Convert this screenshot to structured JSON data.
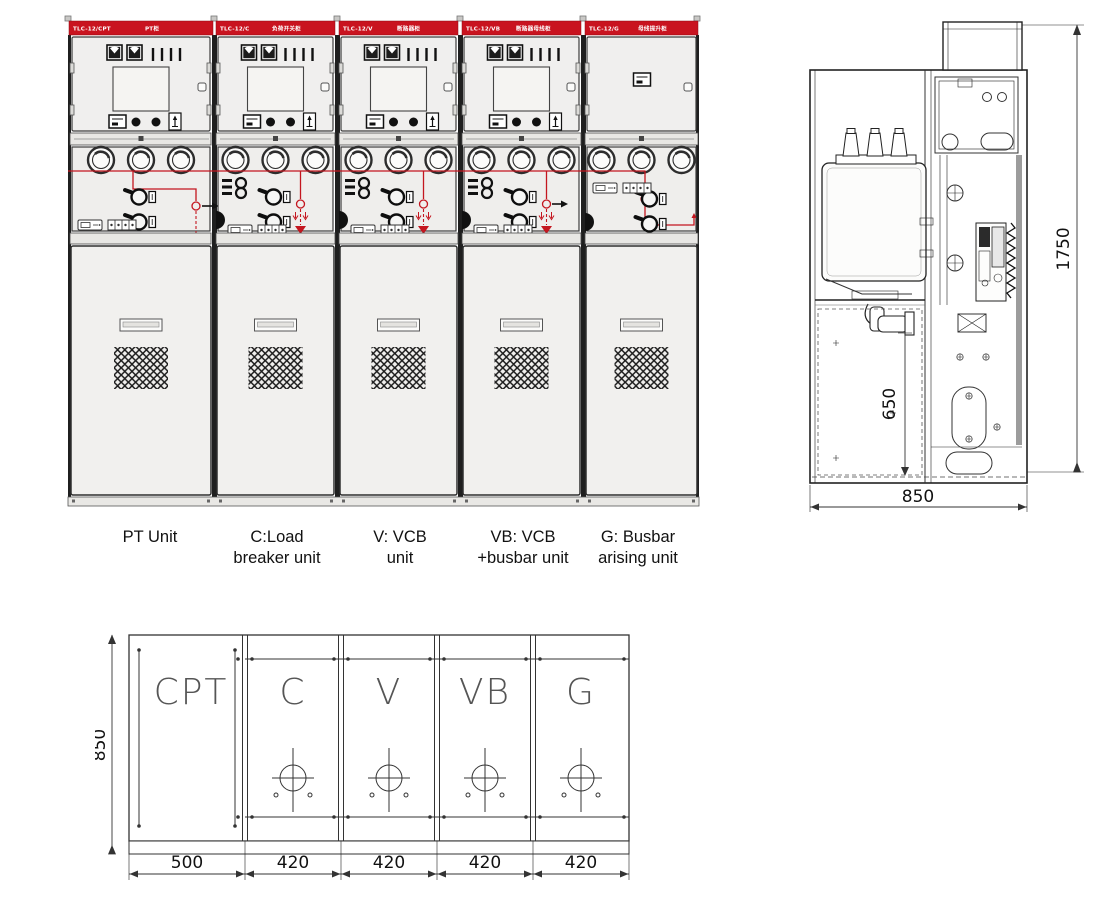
{
  "front_view": {
    "panels": [
      {
        "model": "TLC-12/CPT",
        "name_cn": "PT柜"
      },
      {
        "model": "TLC-12/C",
        "name_cn": "负荷开关柜"
      },
      {
        "model": "TLC-12/V",
        "name_cn": "断路器柜"
      },
      {
        "model": "TLC-12/VB",
        "name_cn": "断路器母线柜"
      },
      {
        "model": "TLC-12/G",
        "name_cn": "母线提升柜"
      }
    ]
  },
  "unit_labels": [
    {
      "line1": "PT Unit",
      "line2": ""
    },
    {
      "line1": "C:Load",
      "line2": "breaker unit"
    },
    {
      "line1": "V: VCB",
      "line2": "unit"
    },
    {
      "line1": "VB: VCB",
      "line2": "+busbar unit"
    },
    {
      "line1": "G: Busbar",
      "line2": "arising unit"
    }
  ],
  "side_view": {
    "dims": {
      "height": "1750",
      "depth": "850",
      "inner_height": "650"
    }
  },
  "plan_view": {
    "height_dim": "850",
    "columns": [
      {
        "label": "CPT",
        "width_dim": "500"
      },
      {
        "label": "C",
        "width_dim": "420"
      },
      {
        "label": "V",
        "width_dim": "420"
      },
      {
        "label": "VB",
        "width_dim": "420"
      },
      {
        "label": "G",
        "width_dim": "420"
      }
    ]
  },
  "colors": {
    "header_red": "#c9131f",
    "mimic_red": "#c4161f",
    "panel_gray": "#f0efee"
  }
}
